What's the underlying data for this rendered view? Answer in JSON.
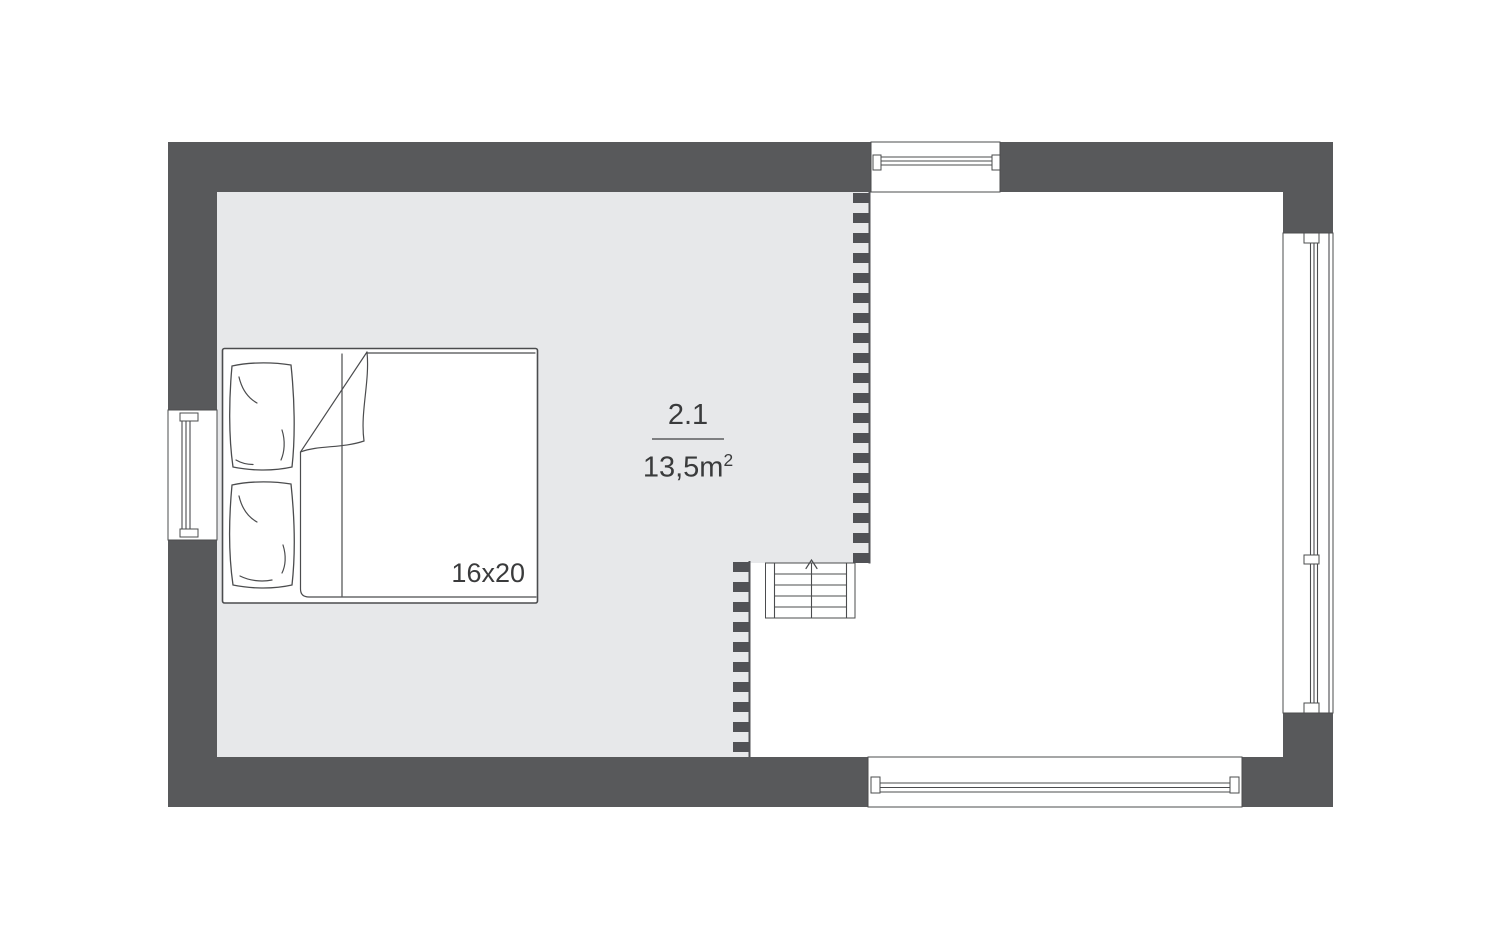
{
  "colors": {
    "page_bg": "#ffffff",
    "wall": "#58595b",
    "room_floor": "#e7e8ea",
    "outline": "#4b4c4e",
    "dash": "#515256",
    "divider": "#7e7f81",
    "text": "#3a3b3c"
  },
  "floor_plan": {
    "room": {
      "number": "2.1",
      "area_value": "13,5m",
      "area_exponent": "2"
    },
    "bed": {
      "size_label": "16x20",
      "pillow_count": 2
    },
    "stairs": {
      "direction": "up",
      "treads": 5
    },
    "windows": [
      "top",
      "left",
      "bottom",
      "right"
    ],
    "railings": [
      "upper-loft-edge",
      "lower-loft-edge"
    ]
  }
}
